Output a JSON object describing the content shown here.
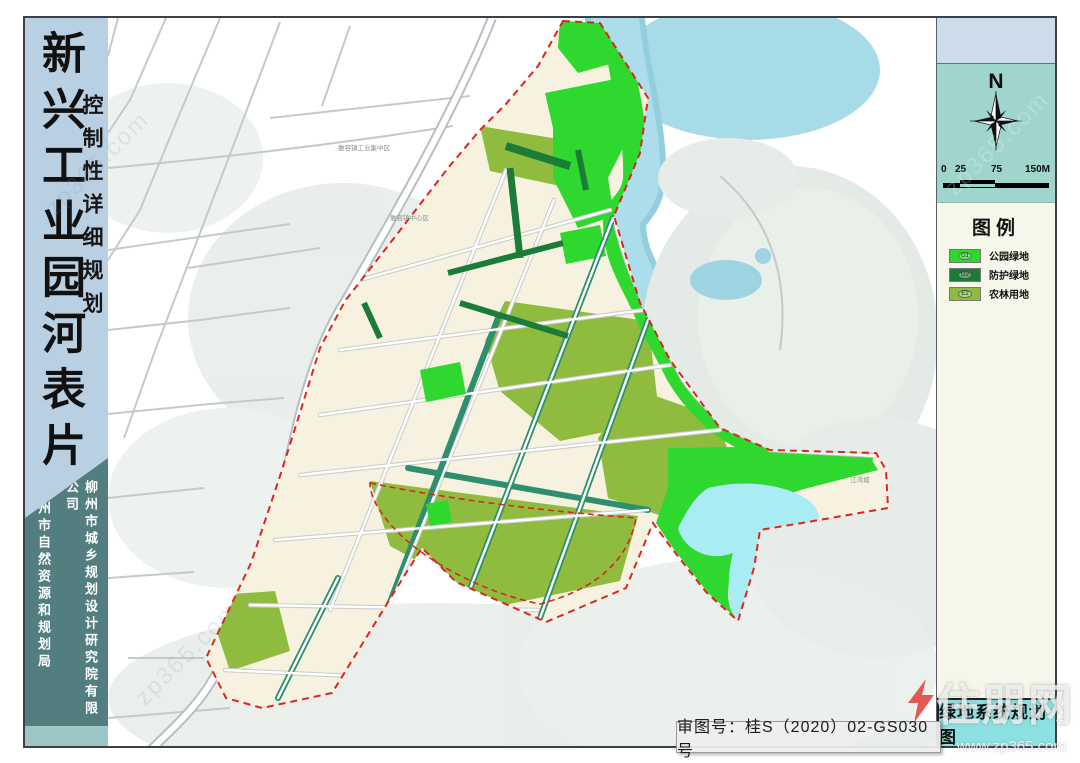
{
  "left_panel": {
    "title": "新兴工业园河表片",
    "subtitle": "控制性详细规划",
    "org_bureau": "柳州市自然资源和规划局",
    "org_institute": "柳州市城乡规划设计研究院有限公司"
  },
  "right_panel": {
    "north": "N",
    "scale_ticks": [
      "0",
      "25",
      "75",
      "150M"
    ],
    "legend_title": "图例",
    "legend": [
      {
        "code": "G1",
        "label": "公园绿地",
        "color": "#2ed82e"
      },
      {
        "code": "G2",
        "label": "防护绿地",
        "color": "#1b7c38"
      },
      {
        "code": "E2",
        "label": "农林用地",
        "color": "#8fbc3f"
      }
    ],
    "map_sheet_title": "绿地系统规划图"
  },
  "footer": {
    "approval_no": "审图号：桂S（2020）02-GS030号"
  },
  "map": {
    "region_labels": [
      "雒容镇工业集中区",
      "雒容镇中心区",
      "江湾城"
    ],
    "colors": {
      "park_green": "#2ed82e",
      "protection_green": "#1b7c38",
      "agroforestry_green": "#8fbc3f",
      "river_blue": "#a8dbe8",
      "lake_cyan": "#a9ecf4",
      "boundary_red": "#d8281e",
      "parcel_cream": "#f7f2df",
      "hill_grey_green": "#e4ebe6"
    }
  },
  "watermarks": {
    "site_name": "住朋网",
    "site_url": "zp365.com",
    "url_text": "www.zp365.com"
  }
}
